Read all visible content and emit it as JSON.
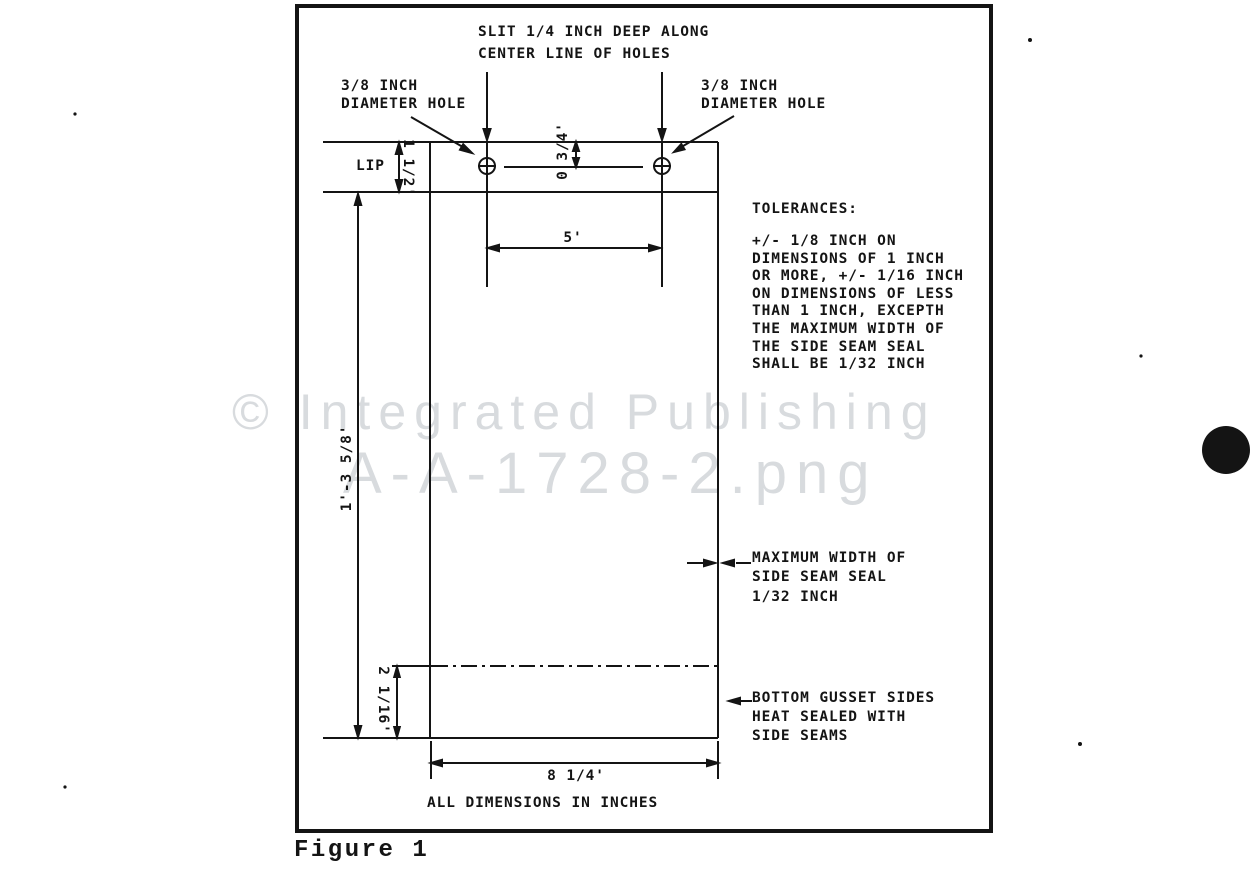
{
  "figure": {
    "caption": "Figure 1",
    "watermark_line1": "© Integrated Publishing",
    "watermark_line2": "A-A-1728-2.png"
  },
  "annotations": {
    "slit_note": {
      "line1": "SLIT 1/4 INCH DEEP ALONG",
      "line2": "CENTER LINE OF HOLES"
    },
    "hole_note_left": {
      "line1": "3/8 INCH",
      "line2": "DIAMETER HOLE"
    },
    "hole_note_right": {
      "line1": "3/8 INCH",
      "line2": "DIAMETER HOLE"
    },
    "lip_label": "LIP",
    "seam_note": {
      "line1": "MAXIMUM WIDTH OF",
      "line2": "SIDE SEAM SEAL",
      "line3": "1/32 INCH"
    },
    "gusset_note": {
      "line1": "BOTTOM GUSSET SIDES",
      "line2": "HEAT SEALED WITH",
      "line3": "SIDE SEAMS"
    },
    "footer_note": "ALL DIMENSIONS IN INCHES"
  },
  "dimensions": {
    "lip_height": "1 1/2'",
    "hole_offset": "0 3/4'",
    "hole_spacing": "5'",
    "bag_length": "1'-3 5/8'",
    "gusset_depth": "2 1/16'",
    "bag_width": "8 1/4'"
  },
  "tolerances": {
    "title": "TOLERANCES:",
    "lines": [
      "+/- 1/8 INCH ON",
      "DIMENSIONS OF 1 INCH",
      "OR MORE, +/- 1/16 INCH",
      "ON DIMENSIONS OF LESS",
      "THAN 1 INCH, EXCEPTH",
      "THE MAXIMUM WIDTH OF",
      "THE SIDE SEAM SEAL",
      "SHALL BE 1/32 INCH"
    ]
  },
  "colors": {
    "ink": "#141414",
    "watermark": "#d8dbde",
    "paper": "#ffffff"
  }
}
